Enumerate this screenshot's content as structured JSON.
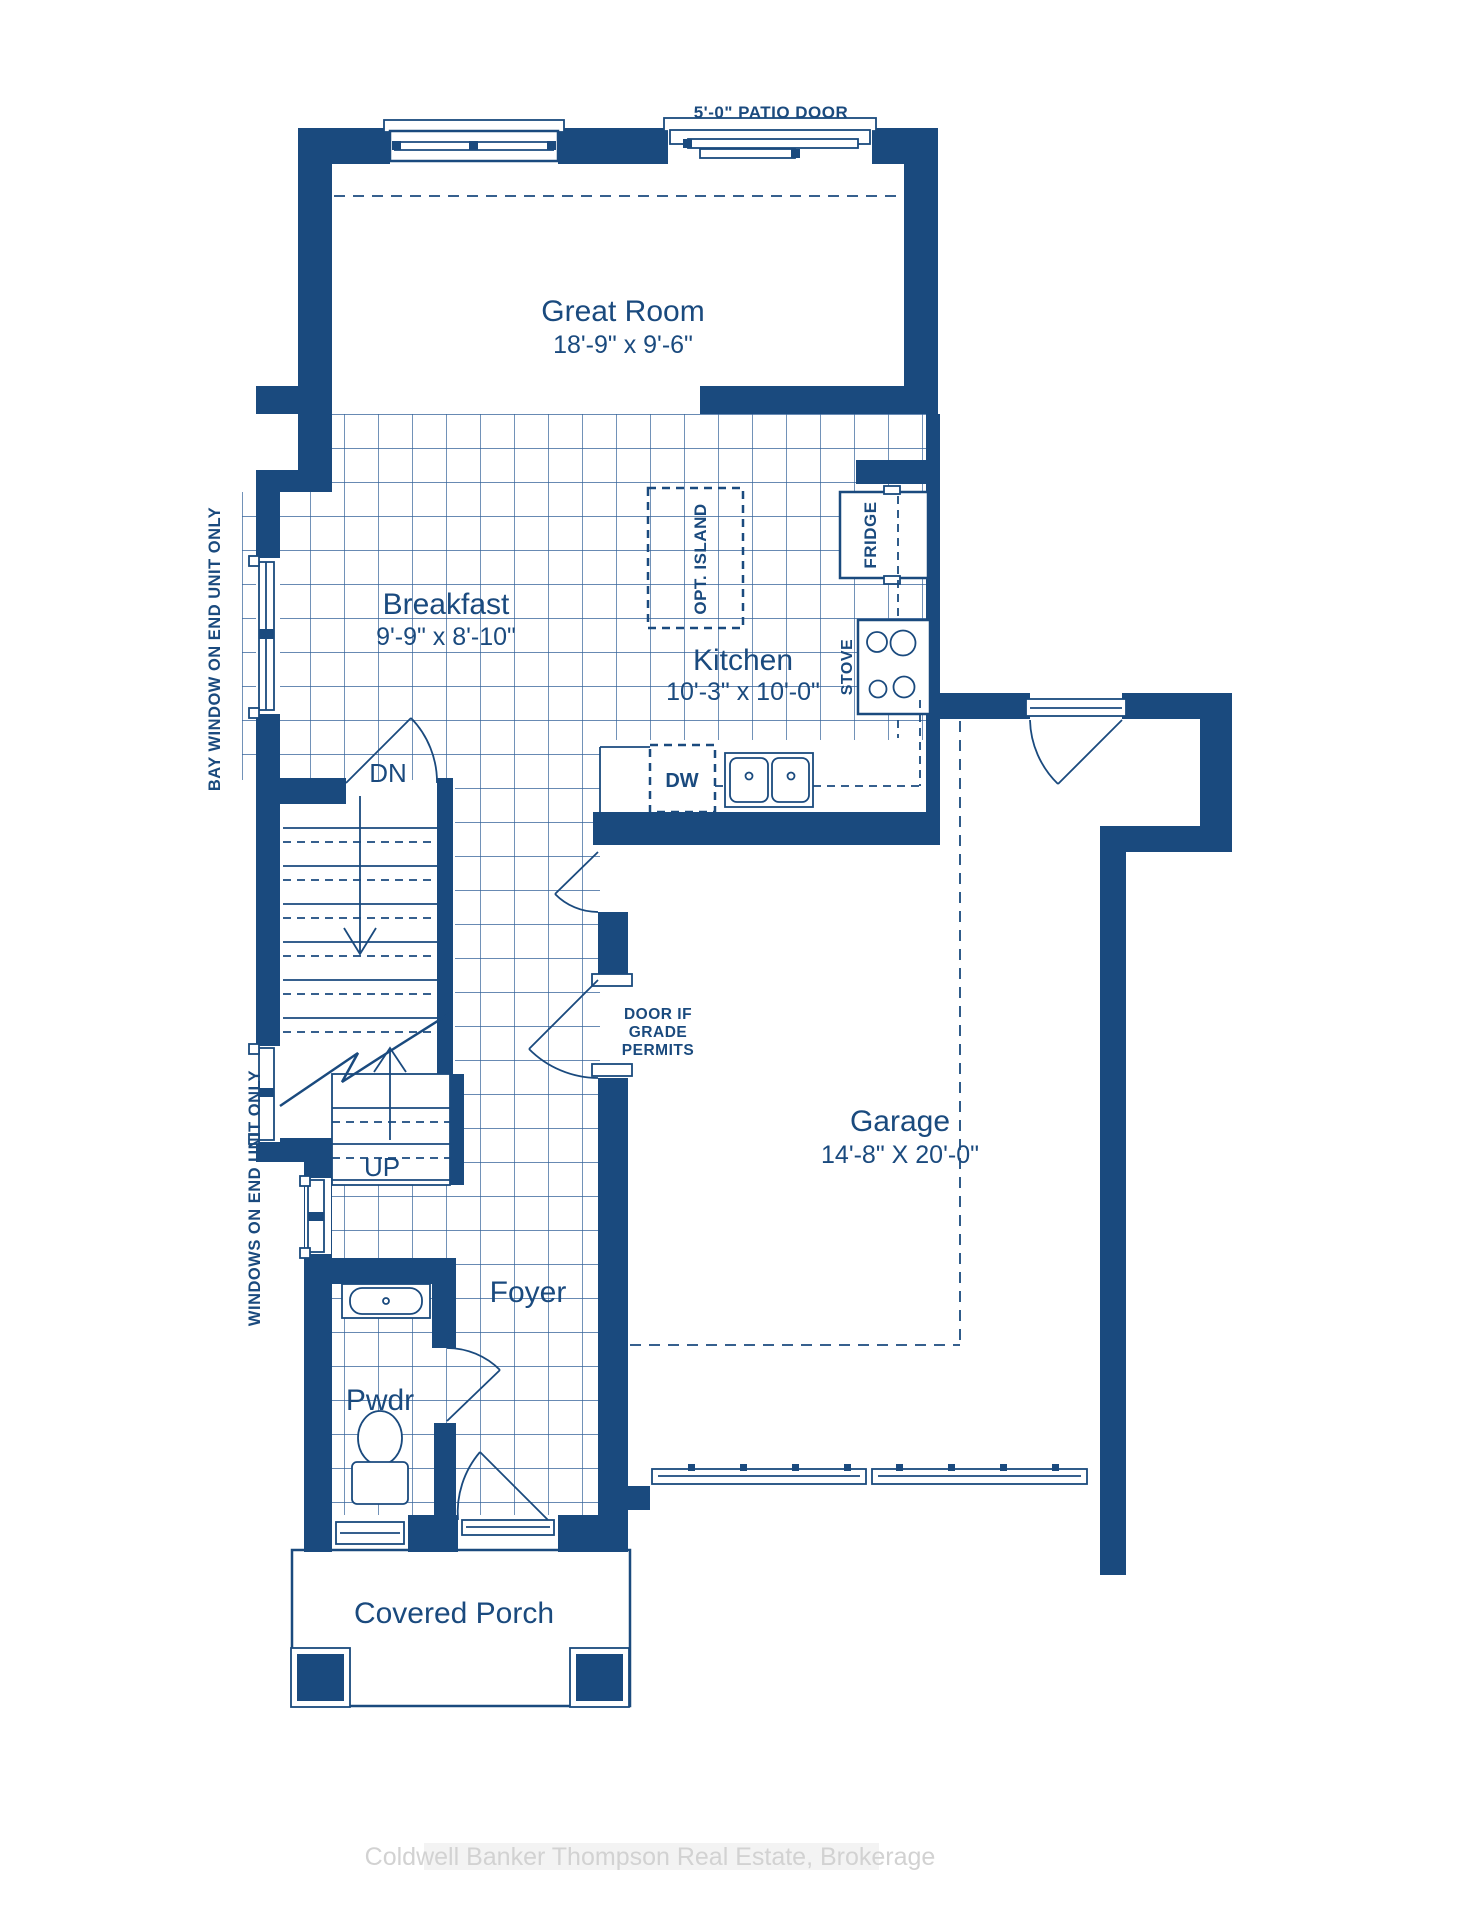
{
  "plan": {
    "patio_door_label": "5'-0\" PATIO DOOR",
    "rooms": {
      "great_room": {
        "name": "Great Room",
        "dims": "18'-9\" x 9'-6\""
      },
      "breakfast": {
        "name": "Breakfast",
        "dims": "9'-9\" x 8'-10\""
      },
      "kitchen": {
        "name": "Kitchen",
        "dims": "10'-3\" x 10'-0\""
      },
      "garage": {
        "name": "Garage",
        "dims": "14'-8\" X 20'-0\""
      },
      "foyer": {
        "name": "Foyer"
      },
      "powder": {
        "name": "Pwdr"
      },
      "porch": {
        "name": "Covered Porch"
      }
    },
    "fixtures": {
      "opt_island": "OPT. ISLAND",
      "fridge": "FRIDGE",
      "stove": "STOVE",
      "dishwasher": "DW"
    },
    "stairs": {
      "down": "DN",
      "up": "UP"
    },
    "notes": {
      "door_grade": [
        "DOOR IF",
        "GRADE",
        "PERMITS"
      ],
      "bay_window": "BAY WINDOW ON END UNIT ONLY",
      "end_windows": "WINDOWS ON END UNIT ONLY"
    },
    "colors": {
      "ink": "#1a4a7e",
      "grid": "#35639a",
      "watermark": "#d2d2d2"
    },
    "watermark": "Coldwell Banker Thompson Real Estate, Brokerage"
  }
}
